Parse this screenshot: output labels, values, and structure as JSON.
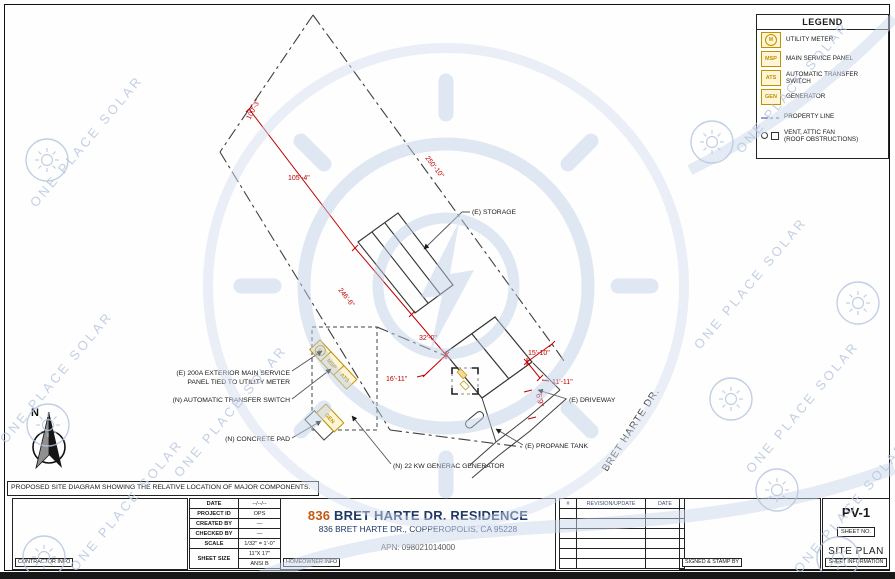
{
  "page": {
    "banner": "PROPOSED SITE DIAGRAM SHOWING THE RELATIVE LOCATION OF MAJOR COMPONENTS.",
    "watermark_text": "ONE PLACE SOLAR",
    "north_label": "N"
  },
  "legend": {
    "title": "LEGEND",
    "icon_m": "M",
    "icon_msp": "MSP",
    "icon_ats": "ATS",
    "icon_gen": "GEN",
    "items": [
      {
        "label1": "UTILITY METER",
        "label2": ""
      },
      {
        "label1": "MAIN SERVICE PANEL",
        "label2": ""
      },
      {
        "label1": "AUTOMATIC TRANSFER",
        "label2": "SWITCH"
      },
      {
        "label1": "GENERATOR",
        "label2": ""
      },
      {
        "label1": "PROPERTY LINE",
        "label2": ""
      },
      {
        "label1": "VENT, ATTIC FAN",
        "label2": "(ROOF OBSTRUCTIONS)"
      }
    ]
  },
  "dims": {
    "d100": "100'-3\"",
    "d105": "105'-4\"",
    "d250": "250'-10\"",
    "d246": "246'-6\"",
    "d32": "32'-0\"",
    "d16": "16'-11\"",
    "d15": "15'-10\"",
    "d11": "11'-11\"",
    "d6": "6'9\""
  },
  "labels": {
    "storage": "(E) STORAGE",
    "msp_line1": "(E) 200A EXTERIOR MAIN SERVICE",
    "msp_line2": "PANEL TIED TO UTILITY METER",
    "ats": "(N) AUTOMATIC TRANSFER SWITCH",
    "concrete_pad": "(N) CONCRETE PAD",
    "generator": "(N) 22 KW GENERAC GENERATOR",
    "driveway": "(E) DRIVEWAY",
    "propane": "(E) PROPANE TANK",
    "street": "BRET HARTE DR.",
    "m": "M",
    "msp": "MSP",
    "ats_tag": "ATS",
    "gen": "GEN"
  },
  "titleblock": {
    "contractor_label": "CONTRACTOR INFO",
    "homeowner_label": "HOMEOWNER INFO",
    "signed_label": "SIGNED & STAMP BY",
    "info_rows": [
      [
        "DATE",
        "--/--/--"
      ],
      [
        "PROJECT ID",
        "OPS"
      ],
      [
        "CREATED BY",
        "—"
      ],
      [
        "CHECKED BY",
        "—"
      ],
      [
        "SCALE",
        "1/32\" = 1'-0\""
      ]
    ],
    "sheet_size_label": "SHEET SIZE",
    "sheet_size_v1": "11\"X 17\"",
    "sheet_size_v2": "ANSI B",
    "title_num": "836",
    "title_rest": "BRET HARTE DR. RESIDENCE",
    "address": "836 BRET HARTE DR., COPPEROPOLIS, CA 95228",
    "apn": "APN: 098021014000",
    "rev_col_num": "#",
    "rev_col_rev": "REVISION/UPDATE",
    "rev_col_date": "DATE",
    "sheet_no": "PV-1",
    "sheet_no_label": "SHEET NO.",
    "sheet_name": "SITE PLAN",
    "sheet_info_label": "SHEET INFORMATION"
  }
}
